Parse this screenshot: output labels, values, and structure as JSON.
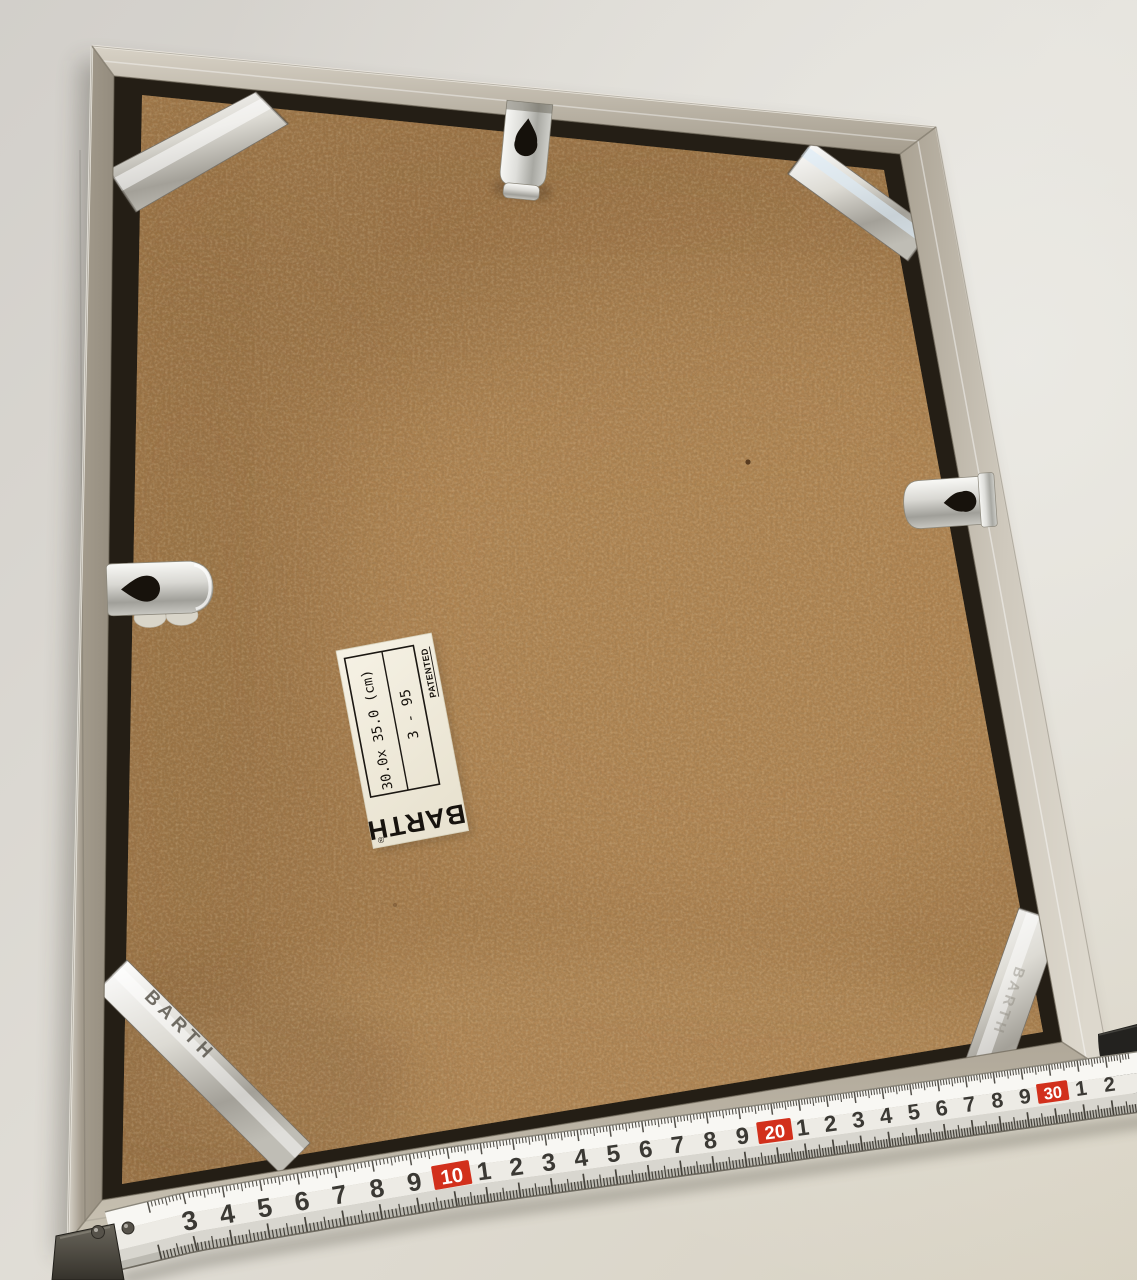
{
  "frame_label": {
    "dimensions": "30.0x 35.0 (cm)",
    "batch": "3 - 95",
    "patented": "PATENTED",
    "brand": "BARTH",
    "registered": "®"
  },
  "clip_stamps": {
    "bottom_left": "BARTH",
    "bottom_right": "BARTH"
  },
  "tape_measure": {
    "red_color": "#d2301c",
    "unit_marks": [
      {
        "v": 3,
        "label": "3"
      },
      {
        "v": 4,
        "label": "4"
      },
      {
        "v": 5,
        "label": "5"
      },
      {
        "v": 6,
        "label": "6"
      },
      {
        "v": 7,
        "label": "7"
      },
      {
        "v": 8,
        "label": "8"
      },
      {
        "v": 9,
        "label": "9"
      },
      {
        "v": 10,
        "label": "10",
        "red": true
      },
      {
        "v": 11,
        "label": "1"
      },
      {
        "v": 12,
        "label": "2"
      },
      {
        "v": 13,
        "label": "3"
      },
      {
        "v": 14,
        "label": "4"
      },
      {
        "v": 15,
        "label": "5"
      },
      {
        "v": 16,
        "label": "6"
      },
      {
        "v": 17,
        "label": "7"
      },
      {
        "v": 18,
        "label": "8"
      },
      {
        "v": 19,
        "label": "9"
      },
      {
        "v": 20,
        "label": "20",
        "red": true
      },
      {
        "v": 21,
        "label": "1"
      },
      {
        "v": 22,
        "label": "2"
      },
      {
        "v": 23,
        "label": "3"
      },
      {
        "v": 24,
        "label": "4"
      },
      {
        "v": 25,
        "label": "5"
      },
      {
        "v": 26,
        "label": "6"
      },
      {
        "v": 27,
        "label": "7"
      },
      {
        "v": 28,
        "label": "8"
      },
      {
        "v": 29,
        "label": "9"
      },
      {
        "v": 30,
        "label": "30",
        "red": true
      },
      {
        "v": 31,
        "label": "1"
      },
      {
        "v": 32,
        "label": "2"
      }
    ]
  },
  "colors": {
    "background": "#dcd8d1",
    "frame_metal": "#b3ab9c",
    "backing_board": "#a57b4b",
    "tape_face": "#edebe5"
  }
}
